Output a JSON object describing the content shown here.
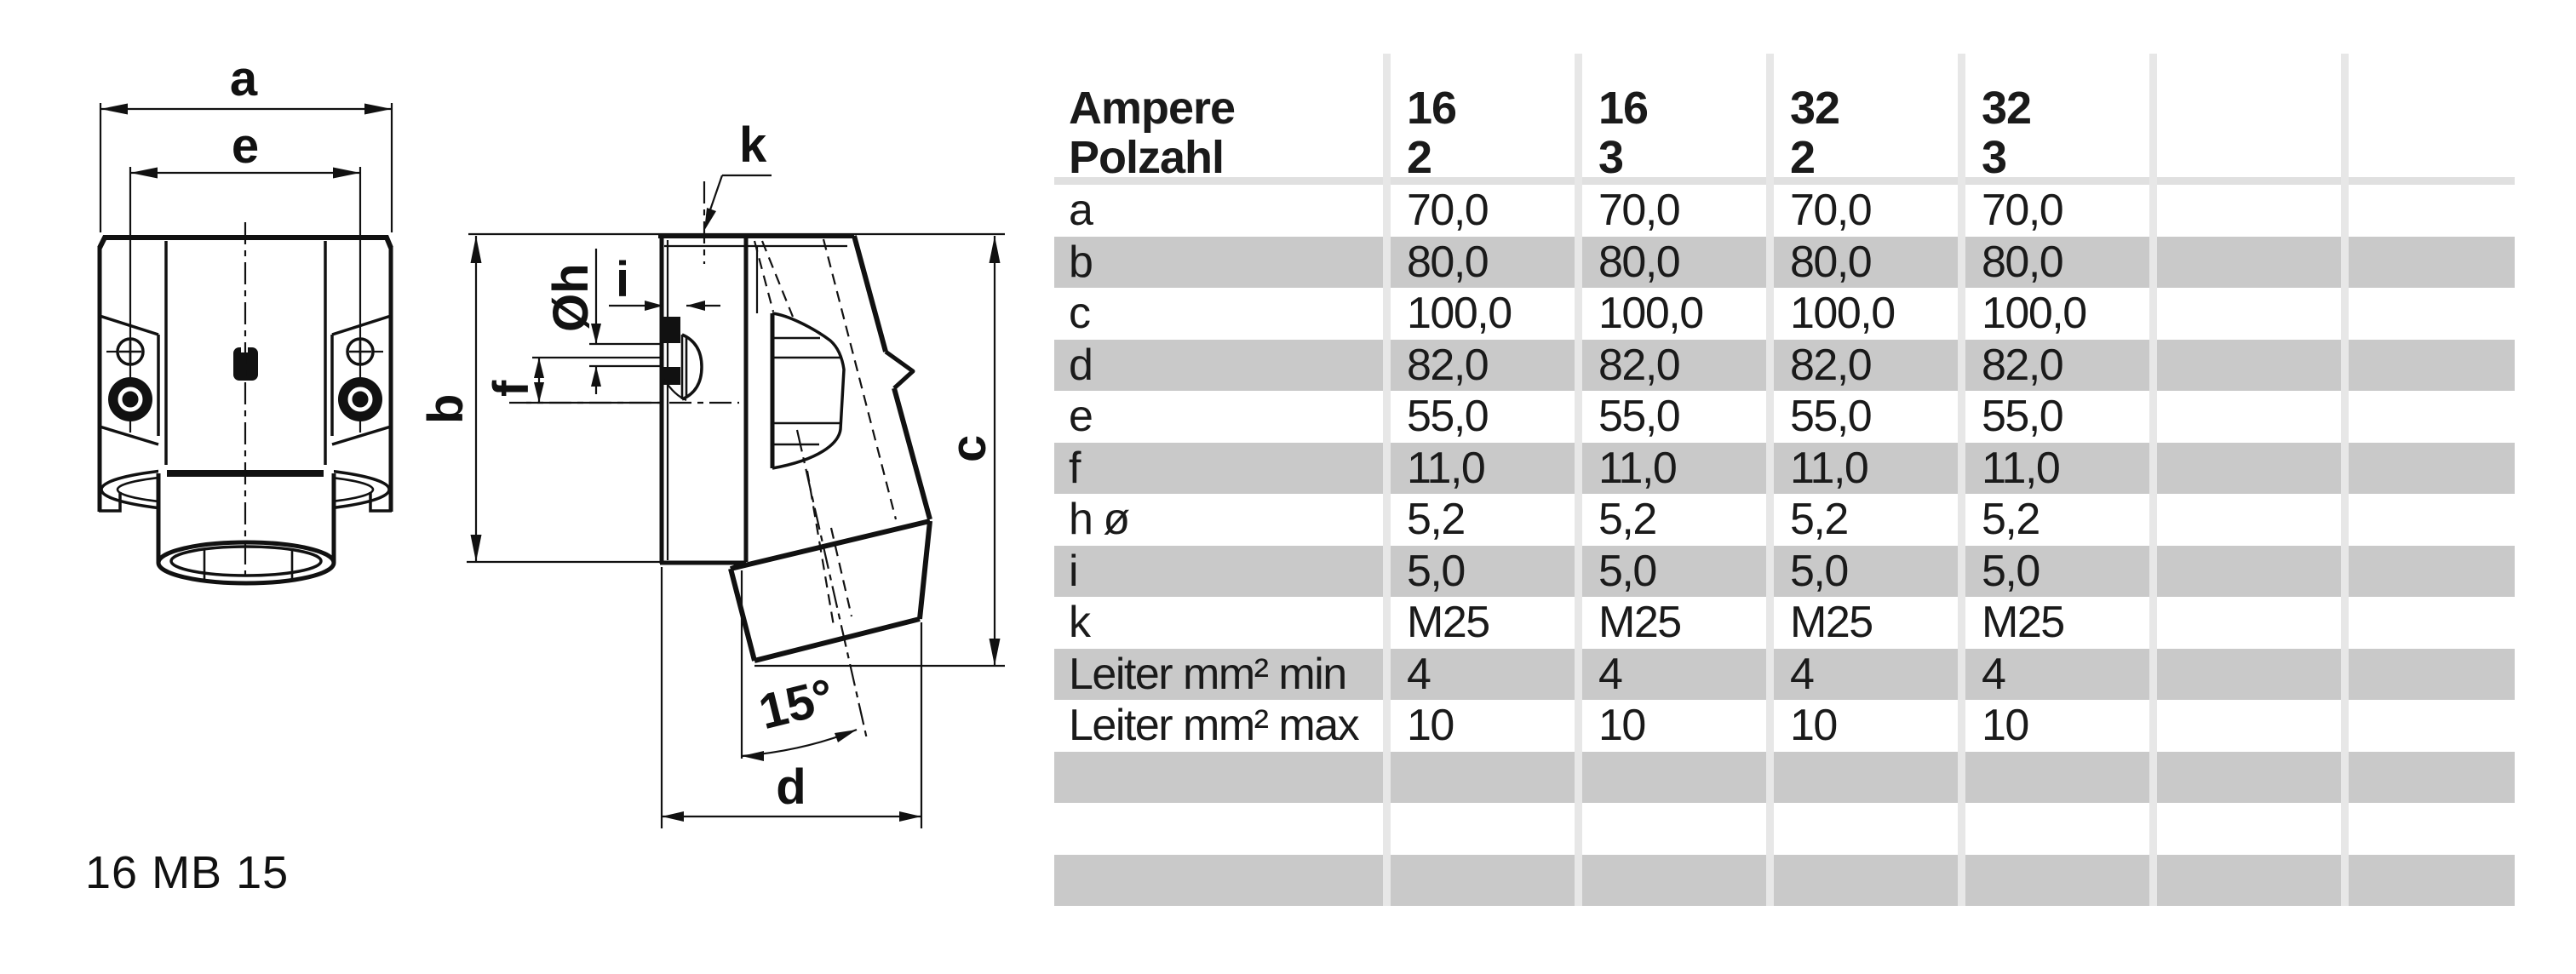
{
  "page": {
    "background": "#ffffff"
  },
  "drawing": {
    "model_label": "16 MB 15",
    "labels": {
      "a": "a",
      "e": "e",
      "b": "b",
      "c": "c",
      "d": "d",
      "f": "f",
      "i": "i",
      "k": "k",
      "dia": "Øh",
      "angle": "15°"
    }
  },
  "table": {
    "header": {
      "row1_label": "Ampere",
      "row2_label": "Polzahl",
      "columns": [
        {
          "ampere": "16",
          "poles": "2"
        },
        {
          "ampere": "16",
          "poles": "3"
        },
        {
          "ampere": "32",
          "poles": "2"
        },
        {
          "ampere": "32",
          "poles": "3"
        }
      ]
    },
    "rows": [
      {
        "label": "a",
        "values": [
          "70,0",
          "70,0",
          "70,0",
          "70,0"
        ]
      },
      {
        "label": "b",
        "values": [
          "80,0",
          "80,0",
          "80,0",
          "80,0"
        ]
      },
      {
        "label": "c",
        "values": [
          "100,0",
          "100,0",
          "100,0",
          "100,0"
        ]
      },
      {
        "label": "d",
        "values": [
          "82,0",
          "82,0",
          "82,0",
          "82,0"
        ]
      },
      {
        "label": "e",
        "values": [
          "55,0",
          "55,0",
          "55,0",
          "55,0"
        ]
      },
      {
        "label": "f",
        "values": [
          "11,0",
          "11,0",
          "11,0",
          "11,0"
        ]
      },
      {
        "label": "h ø",
        "values": [
          "5,2",
          "5,2",
          "5,2",
          "5,2"
        ]
      },
      {
        "label": "i",
        "values": [
          "5,0",
          "5,0",
          "5,0",
          "5,0"
        ]
      },
      {
        "label": "k",
        "values": [
          "M25",
          "M25",
          "M25",
          "M25"
        ]
      },
      {
        "label": "Leiter mm² min",
        "values": [
          "4",
          "4",
          "4",
          "4"
        ]
      },
      {
        "label": "Leiter mm² max",
        "values": [
          "10",
          "10",
          "10",
          "10"
        ]
      }
    ],
    "trailing_empty_rows": 3,
    "empty_data_columns": 2
  },
  "colors": {
    "row_stripe": "#c9c9c9",
    "header_rule": "#e0e0e0",
    "separator": "#e7e7e7",
    "ink": "#111111"
  }
}
